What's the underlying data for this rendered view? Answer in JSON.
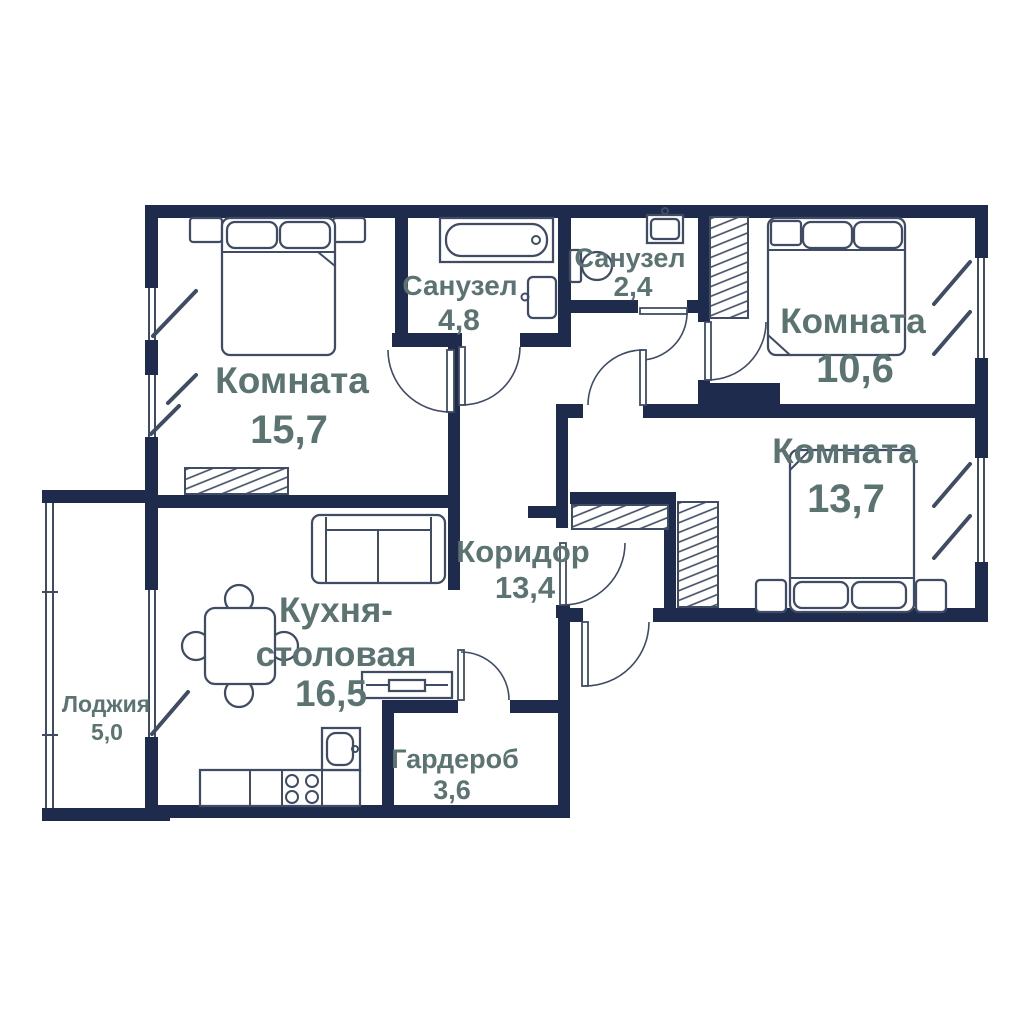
{
  "plan": {
    "title_visible": false,
    "colors": {
      "bg": "#ffffff",
      "wall": "#1f2b4d",
      "label": "#5c7471",
      "line": "#3f4c63"
    },
    "rooms": {
      "bedroom1": {
        "name": "Комната",
        "area": "15,7"
      },
      "bath_big": {
        "name": "Санузел",
        "area": "4,8"
      },
      "bath_small": {
        "name": "Санузел",
        "area": "2,4"
      },
      "bedroom2": {
        "name": "Комната",
        "area": "10,6"
      },
      "bedroom3": {
        "name": "Комната",
        "area": "13,7"
      },
      "corridor": {
        "name": "Коридор",
        "area": "13,4"
      },
      "kitchen": {
        "name1": "Кухня-",
        "name2": "столовая",
        "area": "16,5"
      },
      "wardrobe_room": {
        "name": "Гардероб",
        "area": "3,6"
      },
      "loggia": {
        "name": "Лоджия",
        "area": "5,0"
      }
    },
    "furniture": [
      "double-bed",
      "nightstand",
      "wardrobe",
      "bathtub",
      "sink",
      "toilet",
      "sofa",
      "dining-table",
      "chair",
      "tv-stand",
      "kitchen-counter",
      "stove",
      "kitchen-sink"
    ]
  }
}
